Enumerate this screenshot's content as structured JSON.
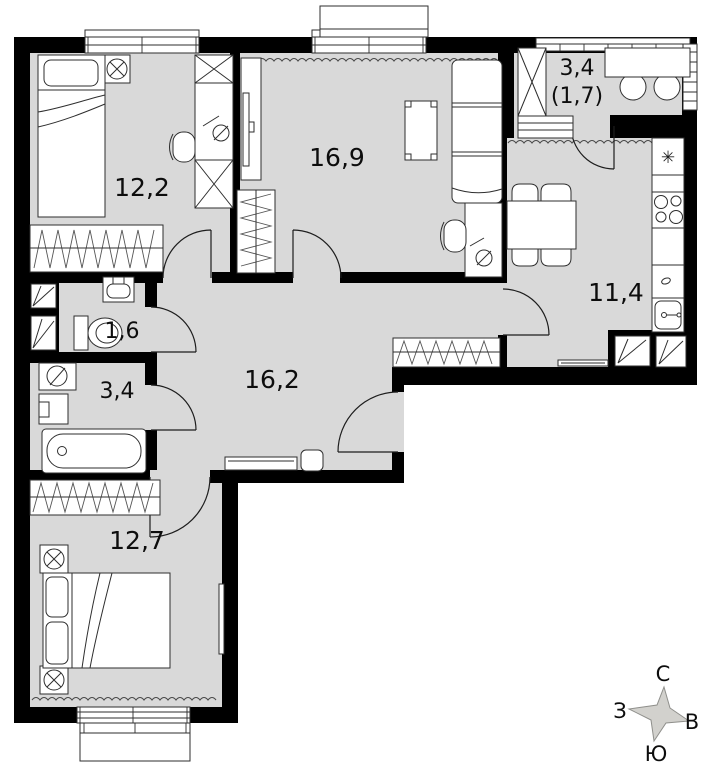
{
  "floorplan": {
    "rooms": [
      {
        "name": "bedroom-1",
        "area": "12,2"
      },
      {
        "name": "living-room",
        "area": "16,9"
      },
      {
        "name": "balcony",
        "area": "3,4",
        "reduced_area": "(1,7)"
      },
      {
        "name": "kitchen",
        "area": "11,4"
      },
      {
        "name": "wc",
        "area": "1,6"
      },
      {
        "name": "bathroom",
        "area": "3,4"
      },
      {
        "name": "hallway",
        "area": "16,2"
      },
      {
        "name": "bedroom-2",
        "area": "12,7"
      }
    ],
    "icons": {
      "fridge_glyph": "✳"
    },
    "compass": {
      "north": "С",
      "south": "Ю",
      "west": "З",
      "east": "В"
    },
    "colors": {
      "floor": "#d9d9d9",
      "walls": "#000000"
    }
  }
}
